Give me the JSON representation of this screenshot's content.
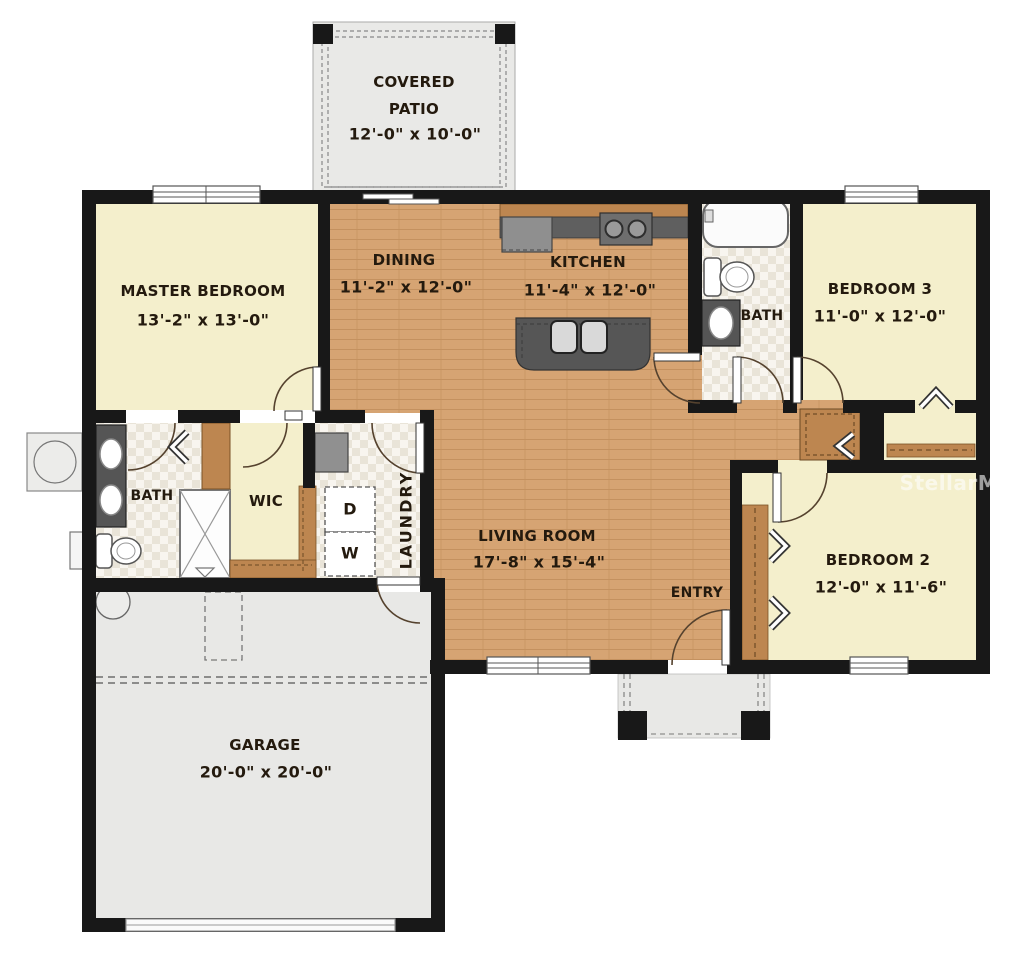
{
  "watermark": "StellarMLS",
  "rooms": {
    "covered_patio": {
      "line1": "COVERED",
      "line2": "PATIO",
      "dims": "12'-0\" x 10'-0\""
    },
    "master_bedroom": {
      "name": "MASTER BEDROOM",
      "dims": "13'-2\" x 13'-0\""
    },
    "dining": {
      "name": "DINING",
      "dims": "11'-2\" x 12'-0\""
    },
    "kitchen": {
      "name": "KITCHEN",
      "dims": "11'-4\" x 12'-0\""
    },
    "bedroom3": {
      "name": "BEDROOM 3",
      "dims": "11'-0\" x 12'-0\""
    },
    "hall_bath": {
      "name": "BATH"
    },
    "master_bath": {
      "name": "BATH"
    },
    "wic": {
      "name": "WIC"
    },
    "laundry": {
      "name": "LAUNDRY",
      "dryer": "D",
      "washer": "W"
    },
    "living_room": {
      "name": "LIVING ROOM",
      "dims": "17'-8\" x 15'-4\""
    },
    "entry": {
      "name": "ENTRY"
    },
    "bedroom2": {
      "name": "BEDROOM 2",
      "dims": "12'-0\" x 11'-6\""
    },
    "garage": {
      "name": "GARAGE",
      "dims": "20'-0\" x 20'-0\""
    }
  },
  "colors": {
    "wall": "#181818",
    "bedroom_floor": "#f4efcc",
    "wood_floor": "#d6a473",
    "wood_cabinet": "#bd8650",
    "tile_light": "#f8f5ef",
    "tile_dark": "#e9e4d8",
    "concrete": "#e8e8e6",
    "counter": "#5f5f5f",
    "watermark_color": "#ffffff"
  }
}
